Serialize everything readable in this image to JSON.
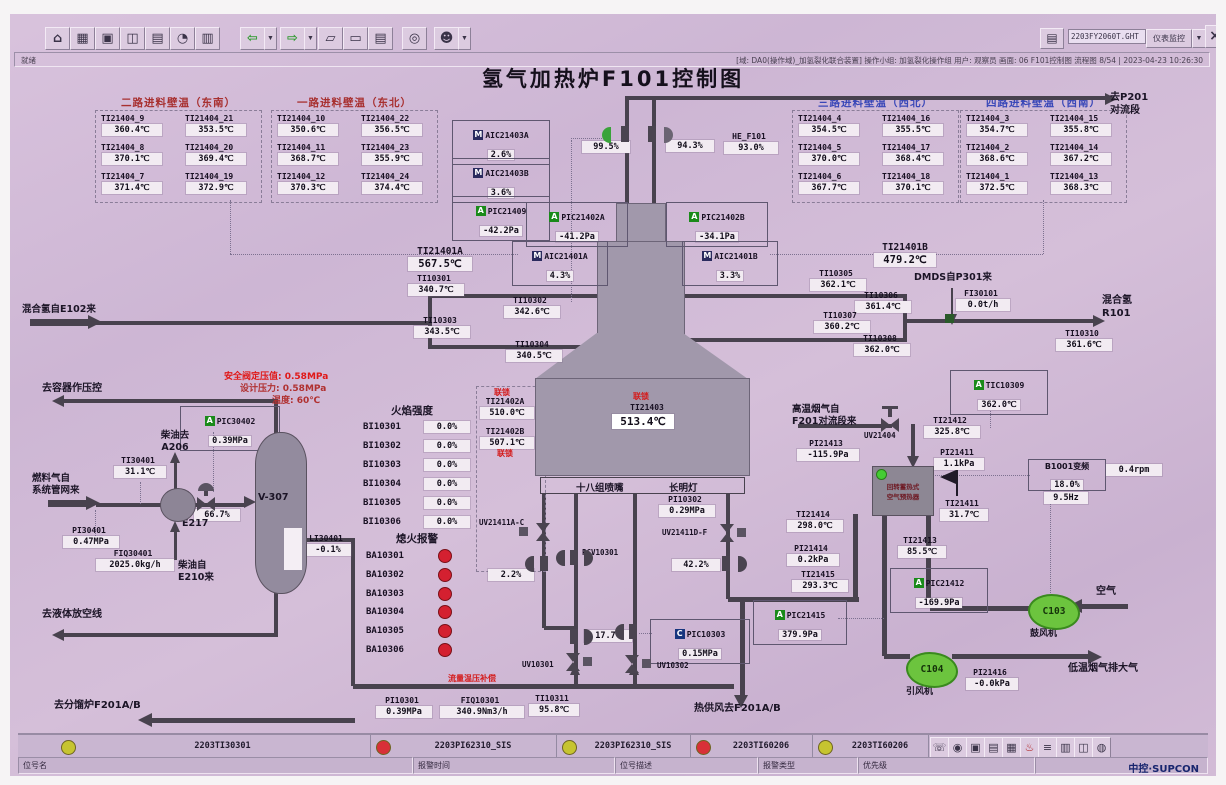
{
  "toolbar": {
    "filename": "2203FY2060T.GHT",
    "monitor_button": "仪表监控",
    "icons": [
      "home",
      "overview",
      "graphics",
      "trend",
      "alarm-summary",
      "clock",
      "report",
      "back",
      "forward",
      "page-prev",
      "page-next",
      "book",
      "search",
      "user"
    ],
    "bottom_icons": [
      "phone",
      "lock",
      "screen",
      "print",
      "table",
      "alarm-bell",
      "list",
      "document",
      "windows",
      "audio"
    ]
  },
  "statusbar": {
    "left": "就绪",
    "right": "[域: DA0(操作域)_加氢裂化联合装置]  操作小组: 加氢裂化操作组  用户: 观察员  画面: 06 F101控制图  流程图 8/54 | 2023-04-23 10:26:30"
  },
  "title": "氢气加热炉F101控制图",
  "wall_temp_groups": [
    {
      "title": "二路进料壁温（东南）",
      "color": "#a83030",
      "tags": [
        [
          "TI21404_9",
          "360.4℃"
        ],
        [
          "TI21404_21",
          "353.5℃"
        ],
        [
          "TI21404_8",
          "370.1℃"
        ],
        [
          "TI21404_20",
          "369.4℃"
        ],
        [
          "TI21404_7",
          "371.4℃"
        ],
        [
          "TI21404_19",
          "372.9℃"
        ]
      ]
    },
    {
      "title": "一路进料壁温（东北）",
      "color": "#a83030",
      "tags": [
        [
          "TI21404_10",
          "350.6℃"
        ],
        [
          "TI21404_22",
          "356.5℃"
        ],
        [
          "TI21404_11",
          "368.7℃"
        ],
        [
          "TI21404_23",
          "355.9℃"
        ],
        [
          "TI21404_12",
          "370.3℃"
        ],
        [
          "TI21404_24",
          "374.4℃"
        ]
      ]
    },
    {
      "title": "三路进料壁温（西北）",
      "color": "#3a48b8",
      "tags": [
        [
          "TI21404_4",
          "354.5℃"
        ],
        [
          "TI21404_16",
          "355.5℃"
        ],
        [
          "TI21404_5",
          "370.0℃"
        ],
        [
          "TI21404_17",
          "368.4℃"
        ],
        [
          "TI21404_6",
          "367.7℃"
        ],
        [
          "TI21404_18",
          "370.1℃"
        ]
      ]
    },
    {
      "title": "四路进料壁温（西南）",
      "color": "#3a48b8",
      "tags": [
        [
          "TI21404_3",
          "354.7℃"
        ],
        [
          "TI21404_15",
          "355.8℃"
        ],
        [
          "TI21404_2",
          "368.6℃"
        ],
        [
          "TI21404_14",
          "367.2℃"
        ],
        [
          "TI21404_1",
          "372.5℃"
        ],
        [
          "TI21404_13",
          "368.3℃"
        ]
      ]
    }
  ],
  "instruments": {
    "aic21403a": {
      "prefix": "M",
      "tag": "AIC21403A",
      "value": "2.6%"
    },
    "aic21403b": {
      "prefix": "M",
      "tag": "AIC21403B",
      "value": "3.6%"
    },
    "pic21409": {
      "prefix": "A",
      "tag": "PIC21409",
      "value": "-42.2Pa"
    },
    "pic21402a": {
      "prefix": "A",
      "tag": "PIC21402A",
      "value": "-41.2Pa"
    },
    "pic21402b": {
      "prefix": "A",
      "tag": "PIC21402B",
      "value": "-34.1Pa"
    },
    "aic21401a": {
      "prefix": "M",
      "tag": "AIC21401A",
      "value": "4.3%"
    },
    "aic21401b": {
      "prefix": "M",
      "tag": "AIC21401B",
      "value": "3.3%"
    },
    "tic10309": {
      "prefix": "A",
      "tag": "TIC10309",
      "value": "362.0℃"
    },
    "pic30402": {
      "prefix": "A",
      "tag": "PIC30402",
      "value": "0.39MPa"
    },
    "pic10303": {
      "prefix": "C",
      "tag": "PIC10303",
      "value": "0.15MPa"
    },
    "pic21412": {
      "prefix": "A",
      "tag": "PIC21412",
      "value": "-169.9Pa"
    },
    "pic21415": {
      "prefix": "A",
      "tag": "PIC21415",
      "value": "379.9Pa"
    },
    "he_f101": {
      "tag": "HE_F101",
      "value": "93.0%"
    },
    "ti21401a": {
      "tag": "TI21401A",
      "value": "567.5℃"
    },
    "ti21401b": {
      "tag": "TI21401B",
      "value": "479.2℃"
    },
    "ti21402a": {
      "tag": "TI21402A",
      "value": "510.0℃"
    },
    "ti21402b": {
      "tag": "TI21402B",
      "value": "507.1℃"
    },
    "ti21403": {
      "tag": "TI21403",
      "value": "513.4℃"
    },
    "ti10301": {
      "tag": "TI10301",
      "value": "340.7℃"
    },
    "ti10302": {
      "tag": "TI10302",
      "value": "342.6℃"
    },
    "ti10303": {
      "tag": "TI10303",
      "value": "343.5℃"
    },
    "ti10304": {
      "tag": "TI10304",
      "value": "340.5℃"
    },
    "ti10305": {
      "tag": "TI10305",
      "value": "362.1℃"
    },
    "ti10306": {
      "tag": "TI10306",
      "value": "361.4℃"
    },
    "ti10307": {
      "tag": "TI10307",
      "value": "360.2℃"
    },
    "ti10308": {
      "tag": "TI10308",
      "value": "362.0℃"
    },
    "ti10310": {
      "tag": "TI10310",
      "value": "361.6℃"
    },
    "ti10311": {
      "tag": "TI10311",
      "value": "95.8℃"
    },
    "fi30101": {
      "tag": "FI30101",
      "value": "0.0t/h"
    },
    "pi10301": {
      "tag": "PI10301",
      "value": "0.39MPa"
    },
    "pi10302": {
      "tag": "PI10302",
      "value": "0.29MPa"
    },
    "fiq10301": {
      "tag": "FIQ10301",
      "value": "340.9Nm3/h"
    },
    "ti30401": {
      "tag": "TI30401",
      "value": "31.1℃"
    },
    "pi30401": {
      "tag": "PI30401",
      "value": "0.47MPa"
    },
    "fiq30401": {
      "tag": "FIQ30401",
      "value": "2025.0kg/h"
    },
    "li30401": {
      "tag": "LI30401",
      "value": "-0.1%"
    },
    "ti21412": {
      "tag": "TI21412",
      "value": "325.8℃"
    },
    "pi21413": {
      "tag": "PI21413",
      "value": "-115.9Pa"
    },
    "pi21411": {
      "tag": "PI21411",
      "value": "1.1kPa"
    },
    "ti21411": {
      "tag": "TI21411",
      "value": "31.7℃"
    },
    "ti21414": {
      "tag": "TI21414",
      "value": "298.0℃"
    },
    "pi21414": {
      "tag": "PI21414",
      "value": "0.2kPa"
    },
    "ti21415": {
      "tag": "TI21415",
      "value": "293.3℃"
    },
    "ti21413": {
      "tag": "TI21413",
      "value": "85.5℃"
    },
    "pi21416": {
      "tag": "PI21416",
      "value": "-0.0kPa"
    },
    "v_stack_l": {
      "value": "99.5%"
    },
    "v_stack_r": {
      "value": "94.3%"
    },
    "v667": {
      "value": "66.7%"
    },
    "v22": {
      "value": "2.2%"
    },
    "v422": {
      "value": "42.2%"
    },
    "v177": {
      "value": "17.7%"
    },
    "uv21404": {
      "tag": "UV21404"
    },
    "uv21411ac": {
      "tag": "UV21411A-C"
    },
    "uv21411df": {
      "tag": "UV21411D-F"
    },
    "pcv10301": {
      "tag": "PCV10301"
    },
    "uv10301": {
      "tag": "UV10301"
    },
    "uv10302": {
      "tag": "UV10302"
    },
    "b1001": {
      "tag": "B1001变频",
      "value": "18.0%",
      "hz": "9.5Hz",
      "rpm": "0.4rpm"
    }
  },
  "labels": {
    "interlock": "联锁",
    "to_p201": "去P201\n对流段",
    "mix_h2_in": "混合氢自E102来",
    "dmds": "DMDS自P301来",
    "mix_h2_out": "混合氢\nR101",
    "to_vessel": "去容器作压控",
    "diesel_to": "柴油去\nA206",
    "fuel_in": "燃料气自\n系统管网来",
    "e217": "E217",
    "v307": "V-307",
    "diesel_from": "柴油自\nE210来",
    "to_drain": "去液体放空线",
    "to_f201": "去分馏炉F201A/B",
    "hot_flue": "高温烟气自\nF201对流段来",
    "preheater": "回转蓄热式\n空气预热器",
    "c103": "C103",
    "c103_sub": "鼓风机",
    "c104": "C104",
    "c104_sub": "引风机",
    "air": "空气",
    "cold_flue": "低温烟气排大气",
    "hot_air": "热供风去F201A/B",
    "burner_header_l": "十八组喷嘴",
    "burner_header_r": "长明灯",
    "flow_comp": "流量温压补偿",
    "flame_title": "火焰强度",
    "flameout_title": "熄火报警"
  },
  "safety_notes": [
    "安全阀定压值: 0.58MPa",
    "设计压力: 0.58MPa",
    "温度: 60℃"
  ],
  "flame_intensity": {
    "rows": [
      {
        "tag": "BI10301",
        "value": "0.0%"
      },
      {
        "tag": "BI10302",
        "value": "0.0%"
      },
      {
        "tag": "BI10303",
        "value": "0.0%"
      },
      {
        "tag": "BI10304",
        "value": "0.0%"
      },
      {
        "tag": "BI10305",
        "value": "0.0%"
      },
      {
        "tag": "BI10306",
        "value": "0.0%"
      }
    ]
  },
  "flameout_alarm": {
    "tags": [
      "BA10301",
      "BA10302",
      "BA10303",
      "BA10304",
      "BA10305",
      "BA10306"
    ]
  },
  "alarm_bar": {
    "cells": [
      {
        "color": "#c6c430",
        "tag": "2203TI30301"
      },
      {
        "color": "#d83038",
        "tag": "2203PI62310_SIS"
      },
      {
        "color": "#c6c430",
        "tag": "2203PI62310_SIS"
      },
      {
        "color": "#d83038",
        "tag": "2203TI60206"
      },
      {
        "color": "#c6c430",
        "tag": "2203TI60206"
      }
    ],
    "fields": [
      "位号名",
      "报警时间",
      "位号描述",
      "报警类型",
      "优先级"
    ],
    "brand": "中控·SUPCON"
  }
}
